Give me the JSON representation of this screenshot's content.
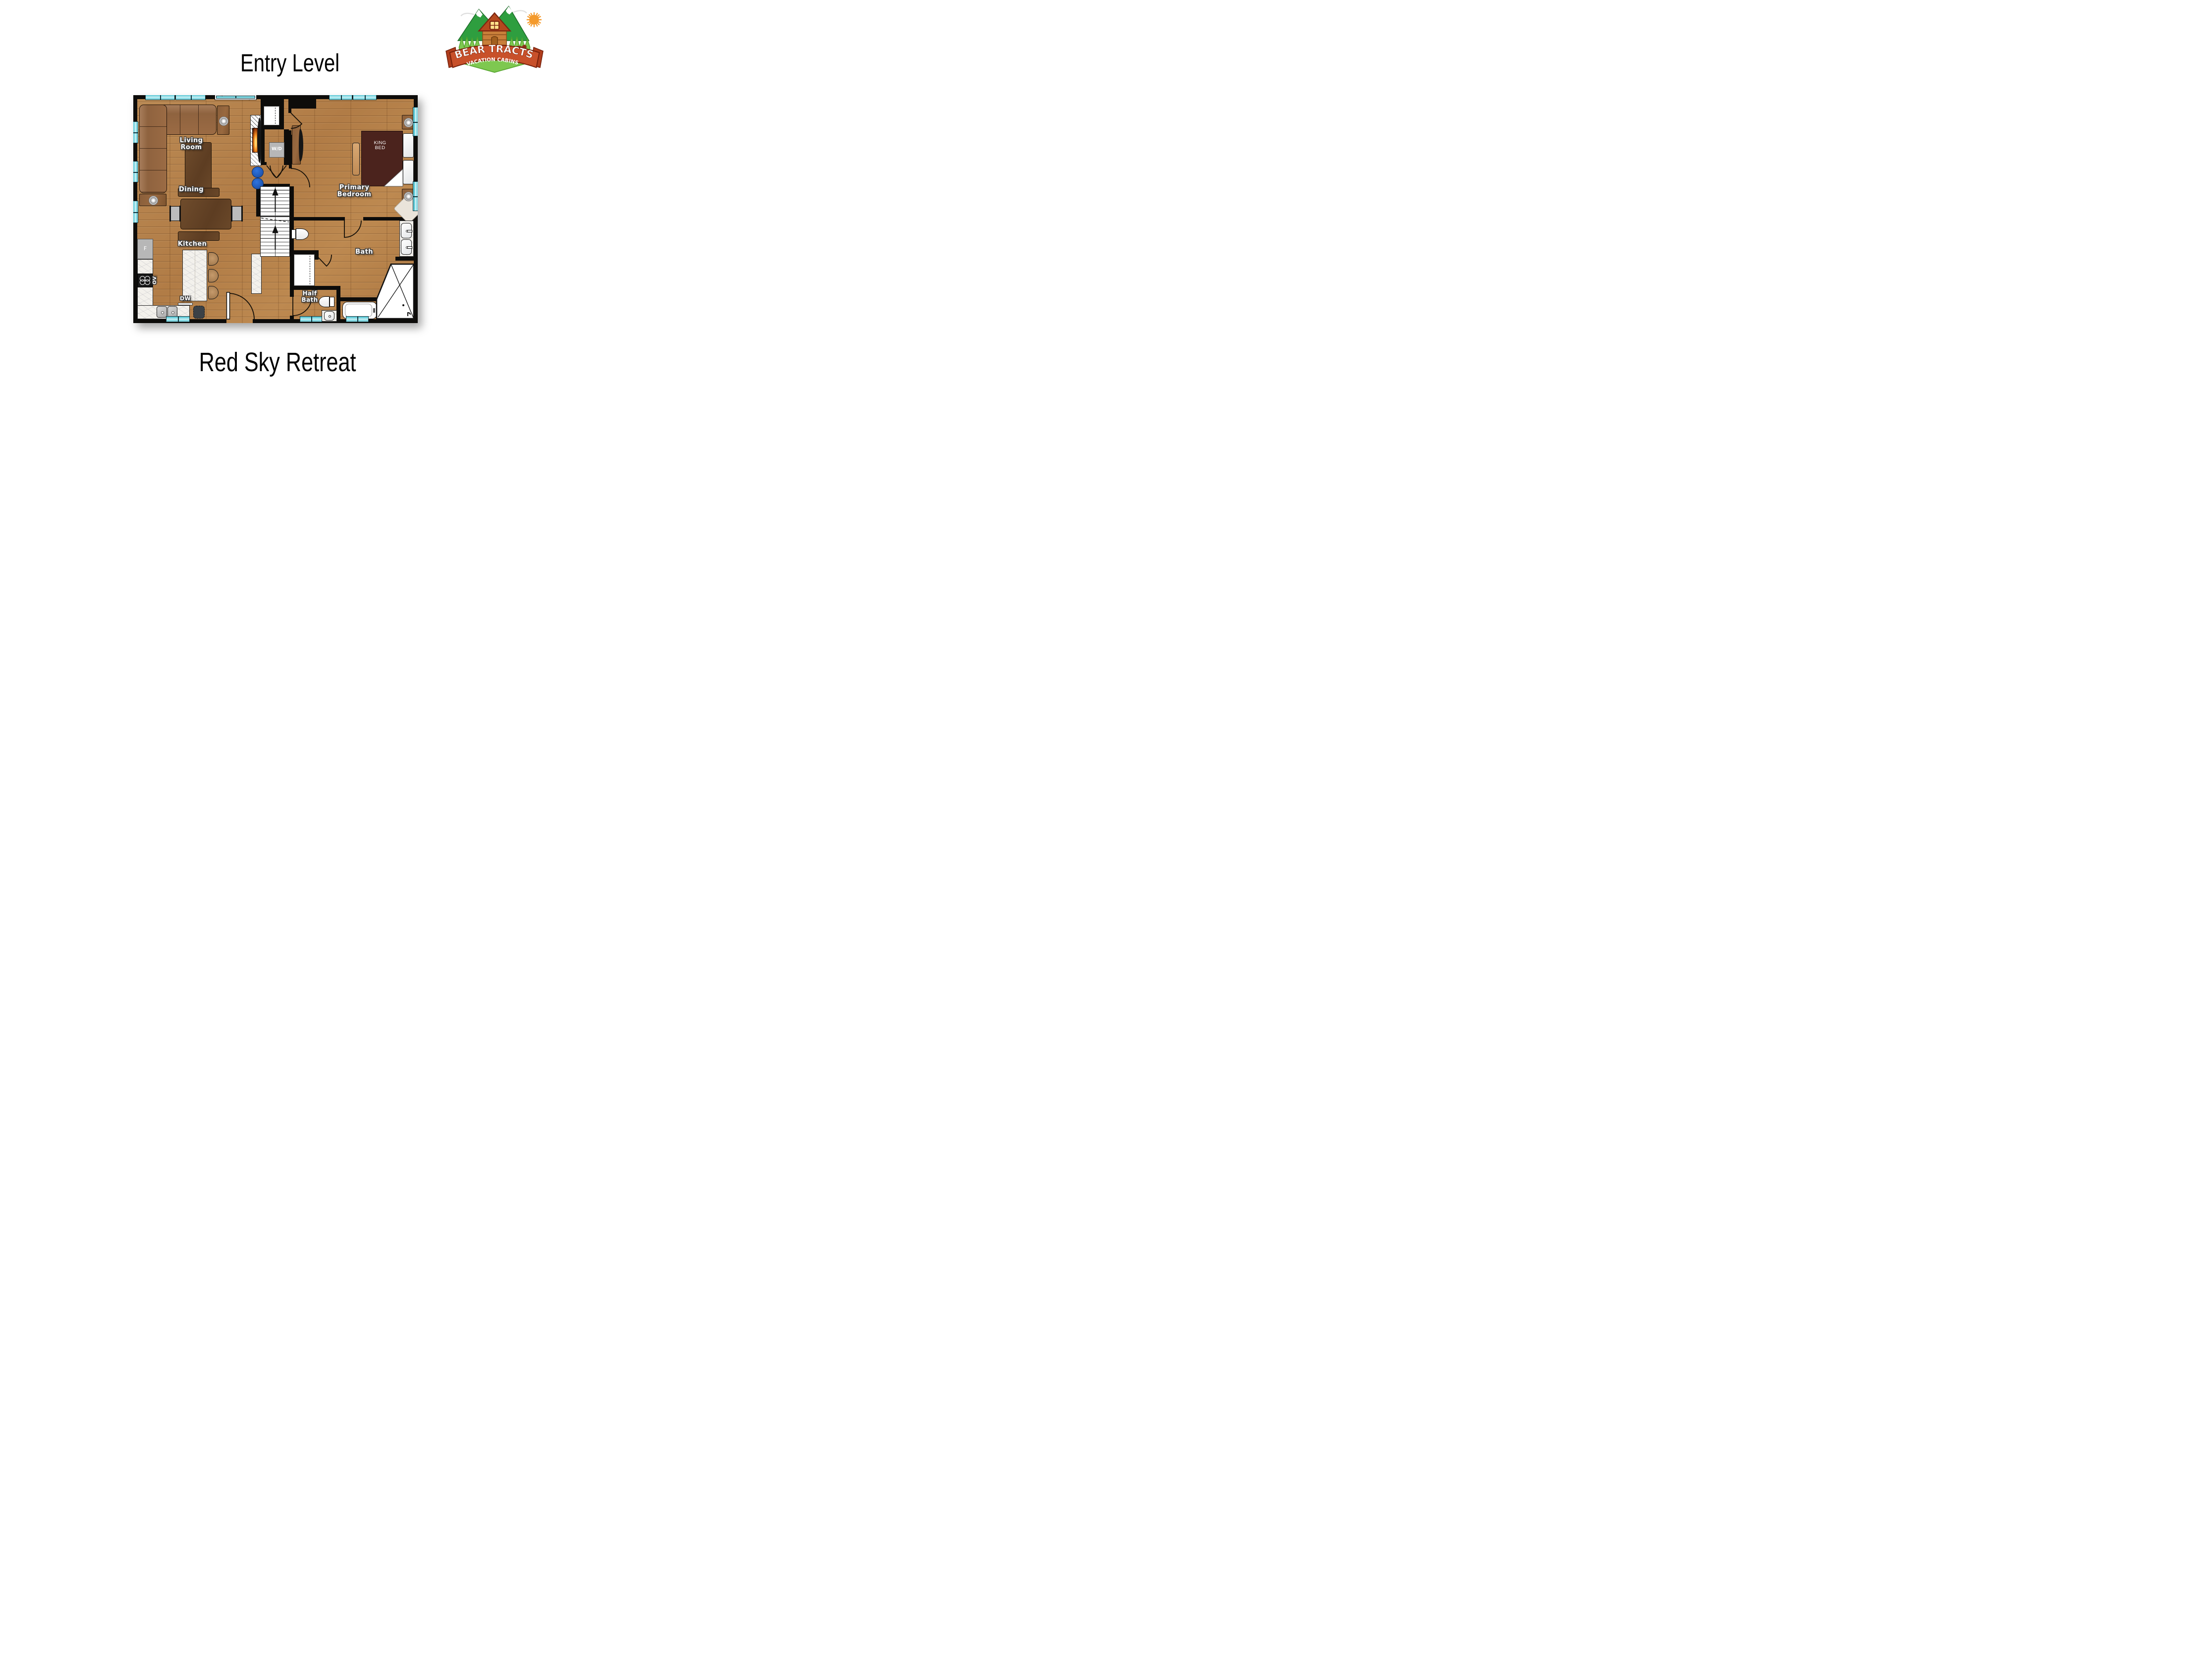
{
  "title": "Entry Level",
  "property_name": "Red Sky Retreat",
  "logo": {
    "brand": "BEAR TRACTS",
    "tagline": "VACATION CABINS"
  },
  "rooms": {
    "living_room": {
      "line1": "Living",
      "line2": "Room"
    },
    "dining": {
      "label": "Dining"
    },
    "kitchen": {
      "label": "Kitchen"
    },
    "primary_bedroom": {
      "line1": "Primary",
      "line2": "Bedroom"
    },
    "bath": {
      "label": "Bath"
    },
    "half_bath": {
      "line1": "Half",
      "line2": "Bath"
    }
  },
  "fixtures": {
    "washer_dryer": "W/D",
    "refrigerator": "F",
    "oven": "OV",
    "dishwasher": "DW",
    "king_bed": {
      "line1": "KING",
      "line2": "BED"
    }
  },
  "colors": {
    "floor_wood": "#b5834e",
    "walls": "#0d0c0a",
    "window_glass": "#7fd6e0",
    "marble_counter": "#f3f1ec",
    "king_bed": "#4b231d",
    "sofa": "#9b6b44",
    "accent_poufs": "#2061c9",
    "logo_green": "#2e9e3f",
    "logo_light_green": "#7ec850",
    "logo_ribbon": "#c8502a",
    "logo_sun": "#f49a2c"
  }
}
